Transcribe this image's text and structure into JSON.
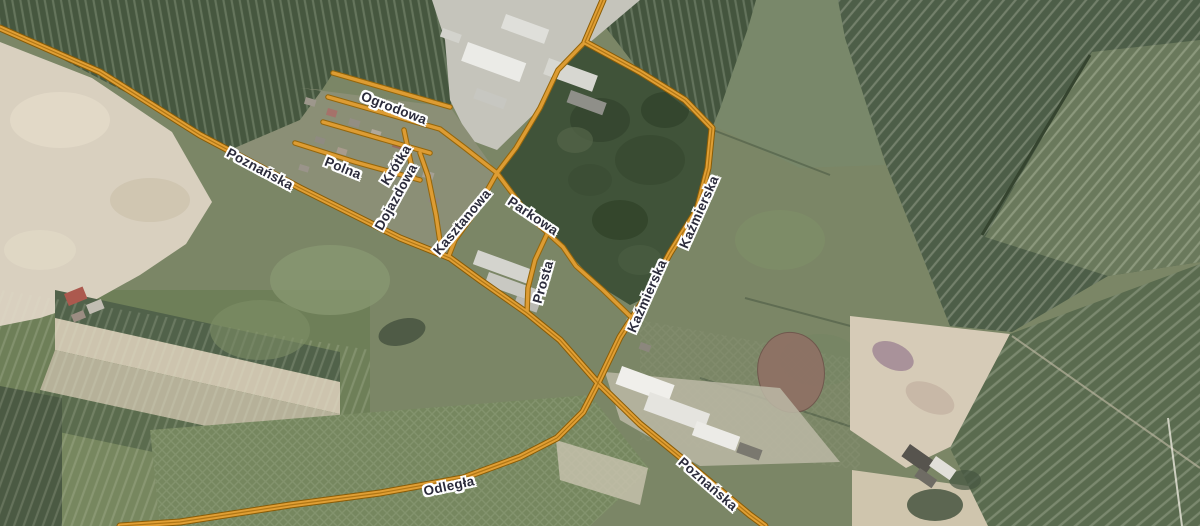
{
  "map": {
    "street_labels": [
      {
        "name": "Ogrodowa"
      },
      {
        "name": "Polna"
      },
      {
        "name": "Krótka"
      },
      {
        "name": "Dojazdowa"
      },
      {
        "name": "Poznańska"
      },
      {
        "name": "Kasztanowa"
      },
      {
        "name": "Parkowa"
      },
      {
        "name": "Prosta"
      },
      {
        "name": "Kaźmierska"
      },
      {
        "name": "Kaźmierska"
      },
      {
        "name": "Odległa"
      },
      {
        "name": "Poznańska"
      }
    ],
    "colors": {
      "road_fill": "#e09f35",
      "road_casing": "#8a5c06",
      "road_centerline": "#b07614",
      "label_text": "#2b2b3b",
      "label_halo": "#ffffff"
    }
  }
}
